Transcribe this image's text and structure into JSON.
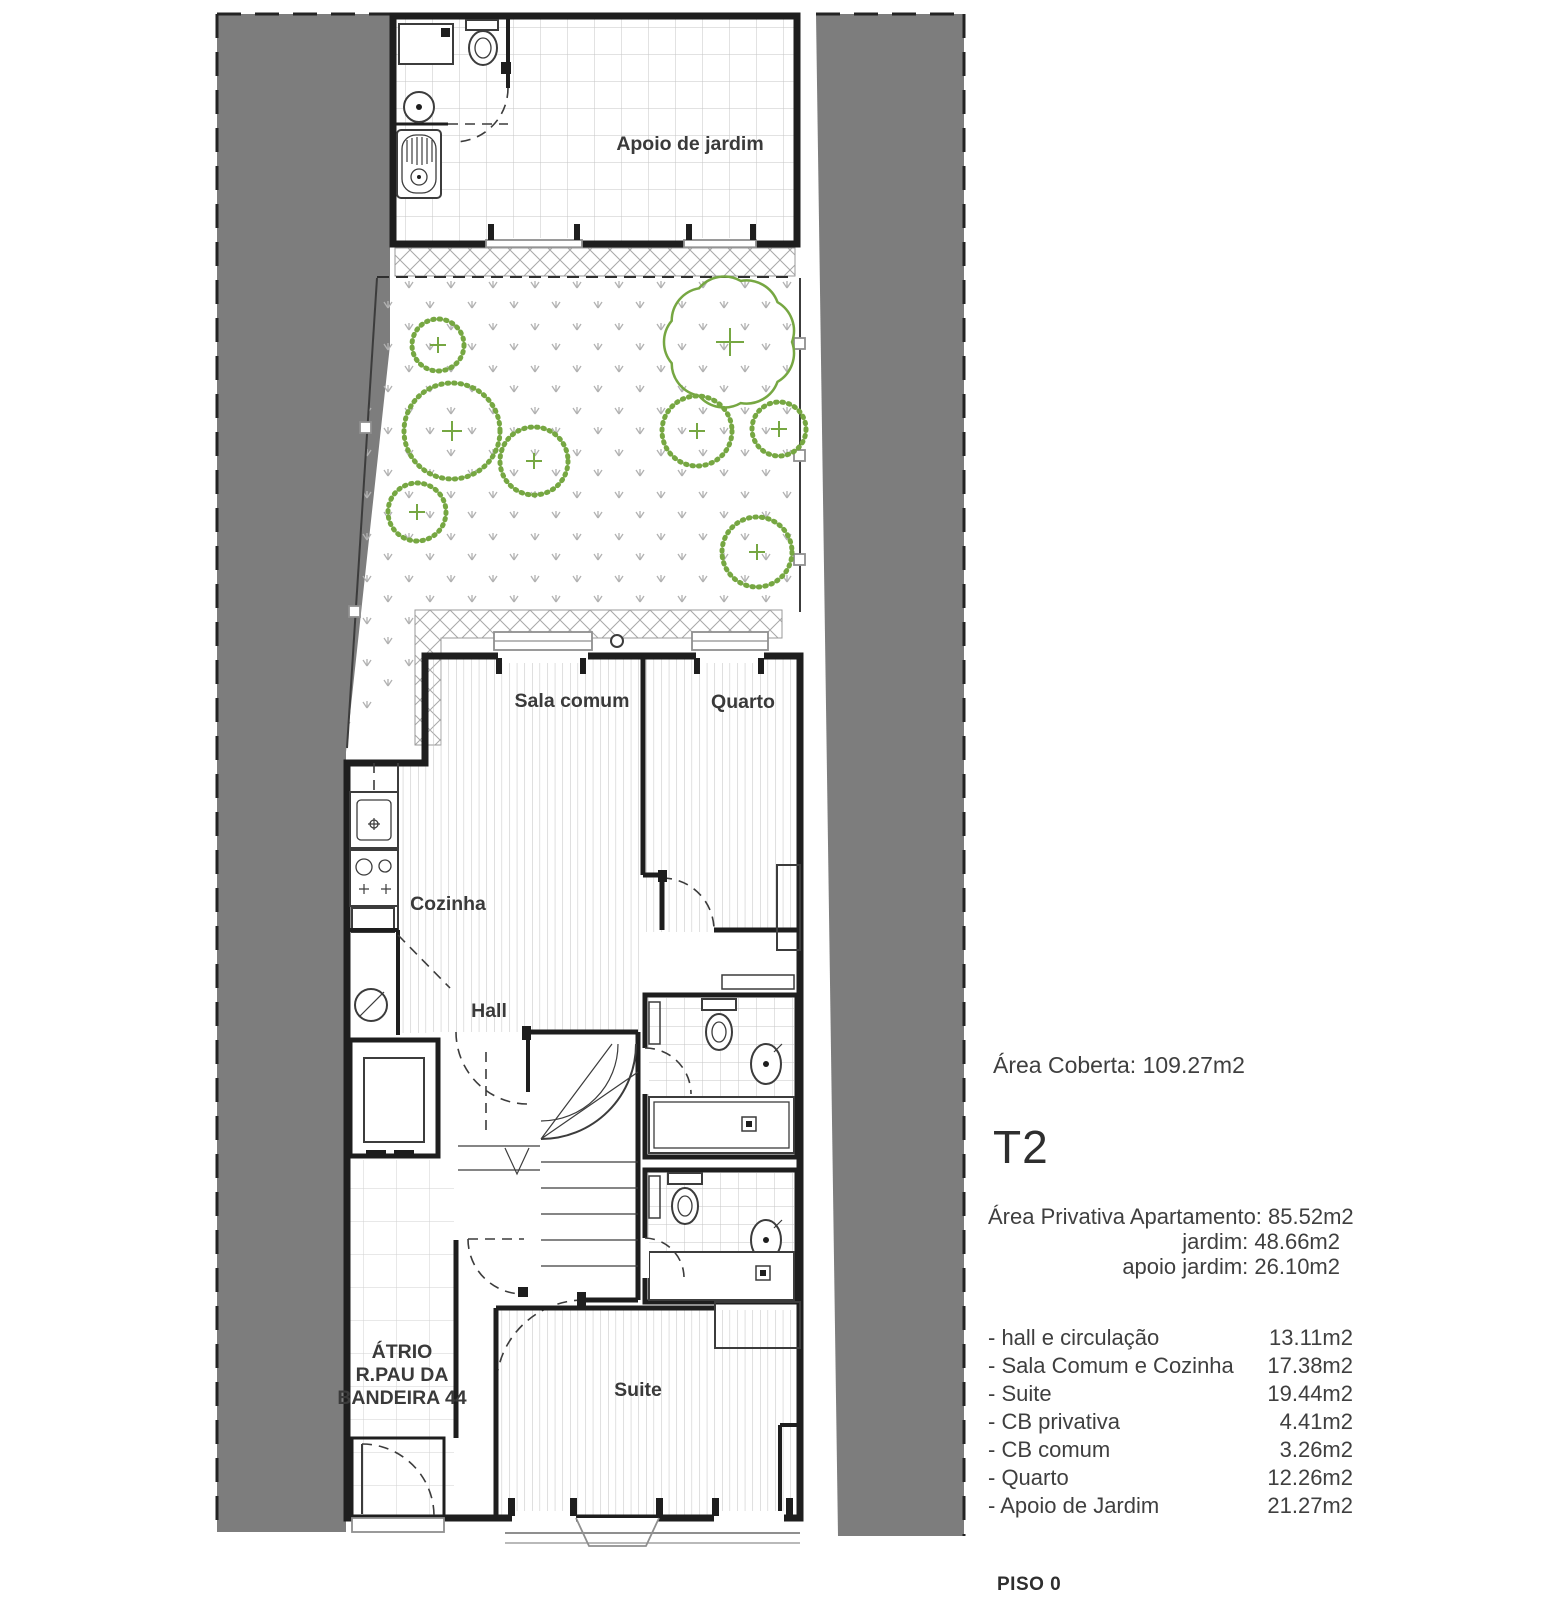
{
  "page": {
    "width": 1556,
    "height": 1609,
    "background": "#ffffff"
  },
  "plan": {
    "labels": {
      "apoio_jardim": "Apoio de jardim",
      "sala_comum": "Sala comum",
      "quarto": "Quarto",
      "cozinha": "Cozinha",
      "hall": "Hall",
      "suite": "Suite",
      "atrio": [
        "ÁTRIO",
        "R.PAU DA",
        "BANDEIRA 44"
      ]
    },
    "colors": {
      "neighbor_buildings": "#7d7d7d",
      "vegetation": "#76a742",
      "walls": "#1e1e1e",
      "pattern_lines": "#c6c6c6",
      "text": "#3a3a3a"
    }
  },
  "info_panel": {
    "area_coberta": "Área Coberta: 109.27m2",
    "unit_type": "T2",
    "private_area_lines": [
      "Área Privativa Apartamento: 85.52m2",
      "jardim: 48.66m2",
      "apoio jardim:  26.10m2"
    ],
    "room_areas": [
      {
        "label": "- hall e circulação",
        "value": "13.11m2"
      },
      {
        "label": "- Sala Comum e Cozinha",
        "value": "17.38m2"
      },
      {
        "label": "- Suite",
        "value": "19.44m2"
      },
      {
        "label": "- CB privativa",
        "value": "4.41m2"
      },
      {
        "label": "- CB comum",
        "value": "3.26m2"
      },
      {
        "label": "- Quarto",
        "value": "12.26m2"
      },
      {
        "label": "- Apoio de Jardim",
        "value": "21.27m2"
      }
    ],
    "floor_label": "PISO 0"
  }
}
